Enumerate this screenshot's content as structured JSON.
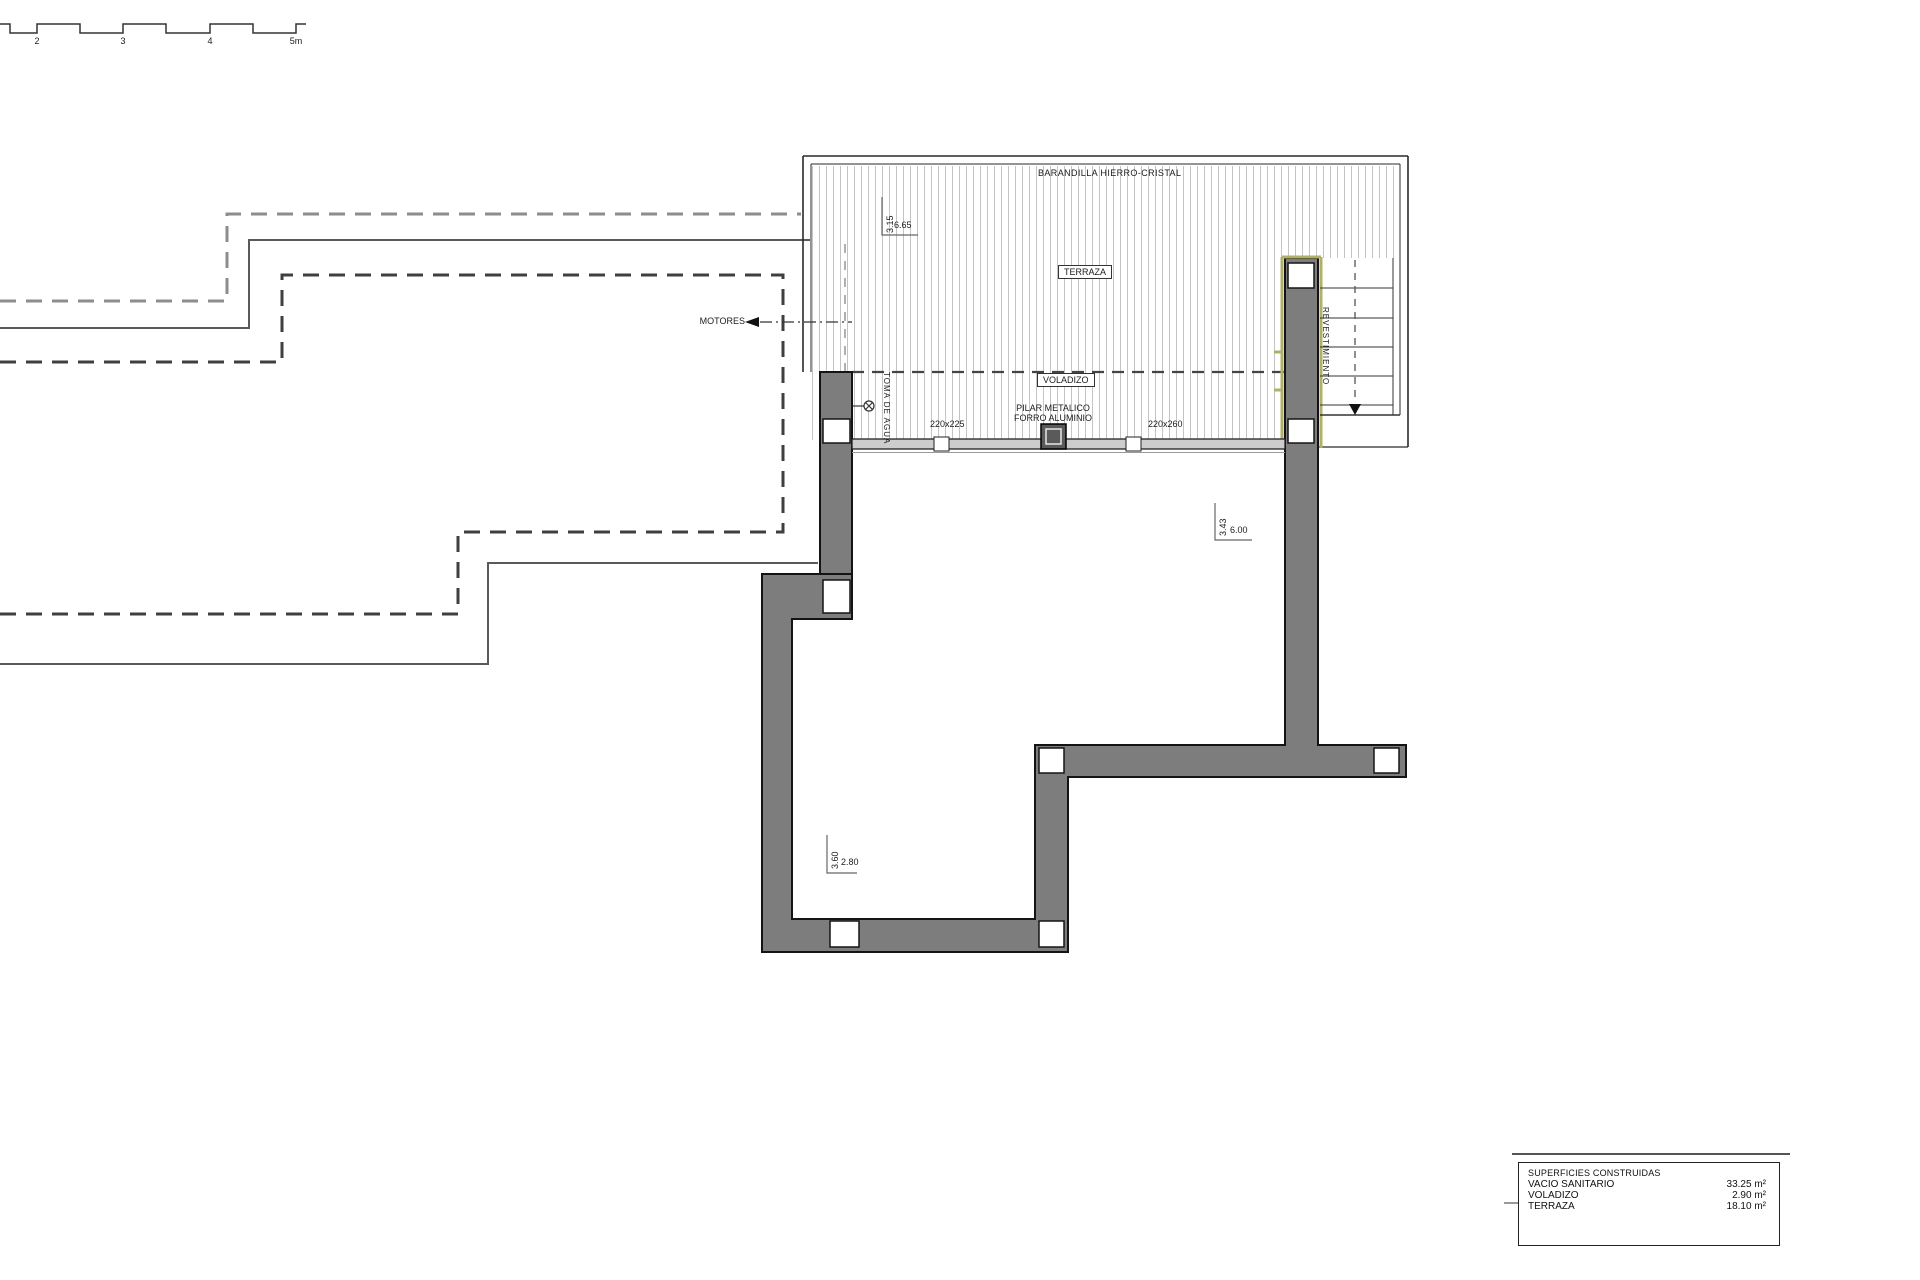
{
  "drawing": {
    "scale_bar": {
      "labels": [
        "2",
        "3",
        "4",
        "5m"
      ]
    },
    "terrace": {
      "barandilla_label": "BARANDILLA HIERRO-CRISTAL",
      "terraza_label": "TERRAZA",
      "voladizo_label": "VOLADIZO",
      "motores_label": "MOTORES",
      "toma_de_agua_label": "TOMA DE AGUA",
      "pilar_label_line1": "PILAR METALICO",
      "pilar_label_line2": "FORRO ALUMINIO",
      "pilar_left_dim": "220x225",
      "pilar_right_dim": "220x260",
      "revestimiento_label": "REVESTIMIENTO"
    },
    "dimensions": {
      "terrace": {
        "vertical": "3.15",
        "horizontal": "6.65"
      },
      "upper_room": {
        "vertical": "3.43",
        "horizontal": "6.00"
      },
      "lower_room": {
        "vertical": "3.60",
        "horizontal": "2.80"
      }
    },
    "areas_table": {
      "header": "SUPERFICIES CONSTRUIDAS",
      "rows": [
        {
          "name": "VACIO SANITARIO",
          "value": "33.25 m²"
        },
        {
          "name": "VOLADIZO",
          "value": "2.90 m²"
        },
        {
          "name": "TERRAZA",
          "value": "18.10 m²"
        }
      ]
    },
    "colors": {
      "wall_fill": "#7d7d7d",
      "wall_outline": "#141414",
      "hatch_line": "#c4c4c4",
      "cladding": "#b0b06a",
      "dashed_outer": "#8d8d8d",
      "dashed_inner": "#3f3f3f"
    }
  }
}
